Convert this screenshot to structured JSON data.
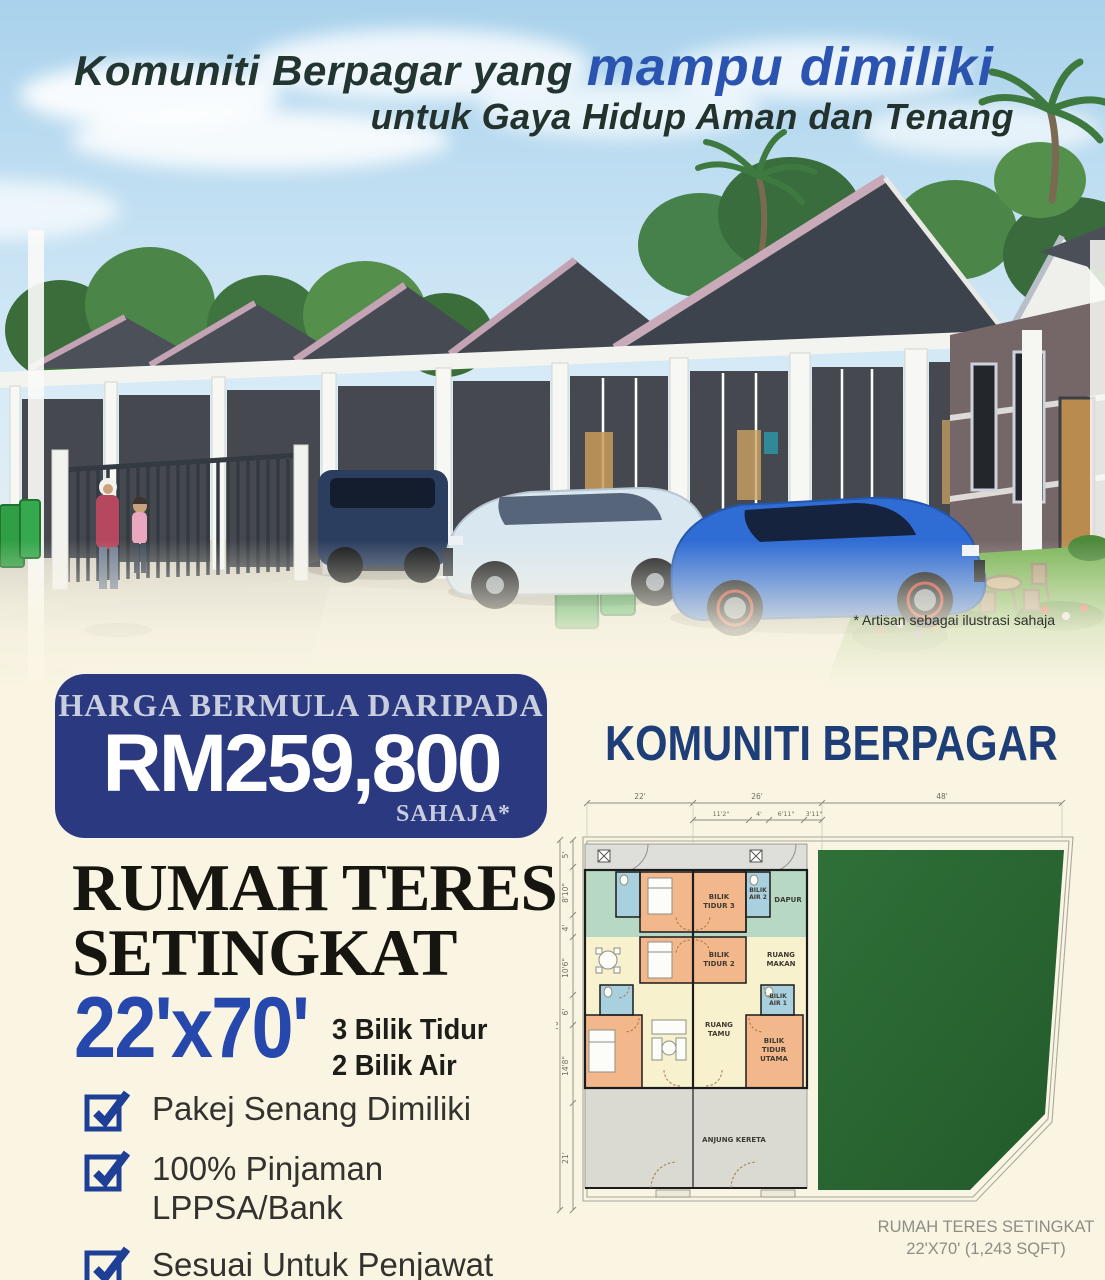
{
  "headline": {
    "part1": "Komuniti Berpagar yang",
    "part2": "mampu dimiliki",
    "line2": "untuk Gaya Hidup Aman dan Tenang"
  },
  "hero": {
    "disclaimer": "* Artisan sebagai ilustrasi sahaja"
  },
  "price_badge": {
    "label": "HARGA BERMULA DARIPADA",
    "price": "RM259,800",
    "suffix": "SAHAJA*"
  },
  "section_title": "KOMUNITI BERPAGAR",
  "product": {
    "title_line1": "RUMAH TERES",
    "title_line2": "SETINGKAT",
    "size": "22'x70'",
    "spec1": "3 Bilik Tidur",
    "spec2": "2 Bilik Air"
  },
  "checklist": [
    {
      "label": "Pakej Senang Dimiliki"
    },
    {
      "label": "100% Pinjaman LPPSA/Bank"
    },
    {
      "label": "Sesuai Untuk Penjawat Awam & Swasta"
    }
  ],
  "floor_plan": {
    "dims_top": [
      "22'",
      "26'",
      "48'"
    ],
    "dims_top_sub": [
      "11'2\"",
      "4'",
      "6'11\"",
      "3'11\""
    ],
    "dims_left": [
      "5'",
      "8'10\"",
      "4'",
      "10'6\"",
      "6'",
      "14'8\"",
      "21'"
    ],
    "dim_overall": "70'",
    "rooms": {
      "bilik_tidur_3": [
        "BILIK",
        "TIDUR 3"
      ],
      "bilik_air_2": [
        "BILIK",
        "AIR 2"
      ],
      "dapur": [
        "DAPUR"
      ],
      "bilik_tidur_2": [
        "BILIK",
        "TIDUR 2"
      ],
      "ruang_makan": [
        "RUANG",
        "MAKAN"
      ],
      "bilik_air_1": [
        "BILIK",
        "AIR 1"
      ],
      "ruang_tamu": [
        "RUANG",
        "TAMU"
      ],
      "bilik_tidur_utama": [
        "BILIK",
        "TIDUR",
        "UTAMA"
      ],
      "anjung_kereta": "ANJUNG KERETA"
    },
    "caption_line1": "RUMAH TERES SETINGKAT",
    "caption_line2": "22'X70' (1,243 SQFT)"
  },
  "colors": {
    "navy": "#2b3a80",
    "accent_blue": "#2647ab",
    "title_navy": "#1e3e78",
    "cream": "#faf5e3"
  }
}
